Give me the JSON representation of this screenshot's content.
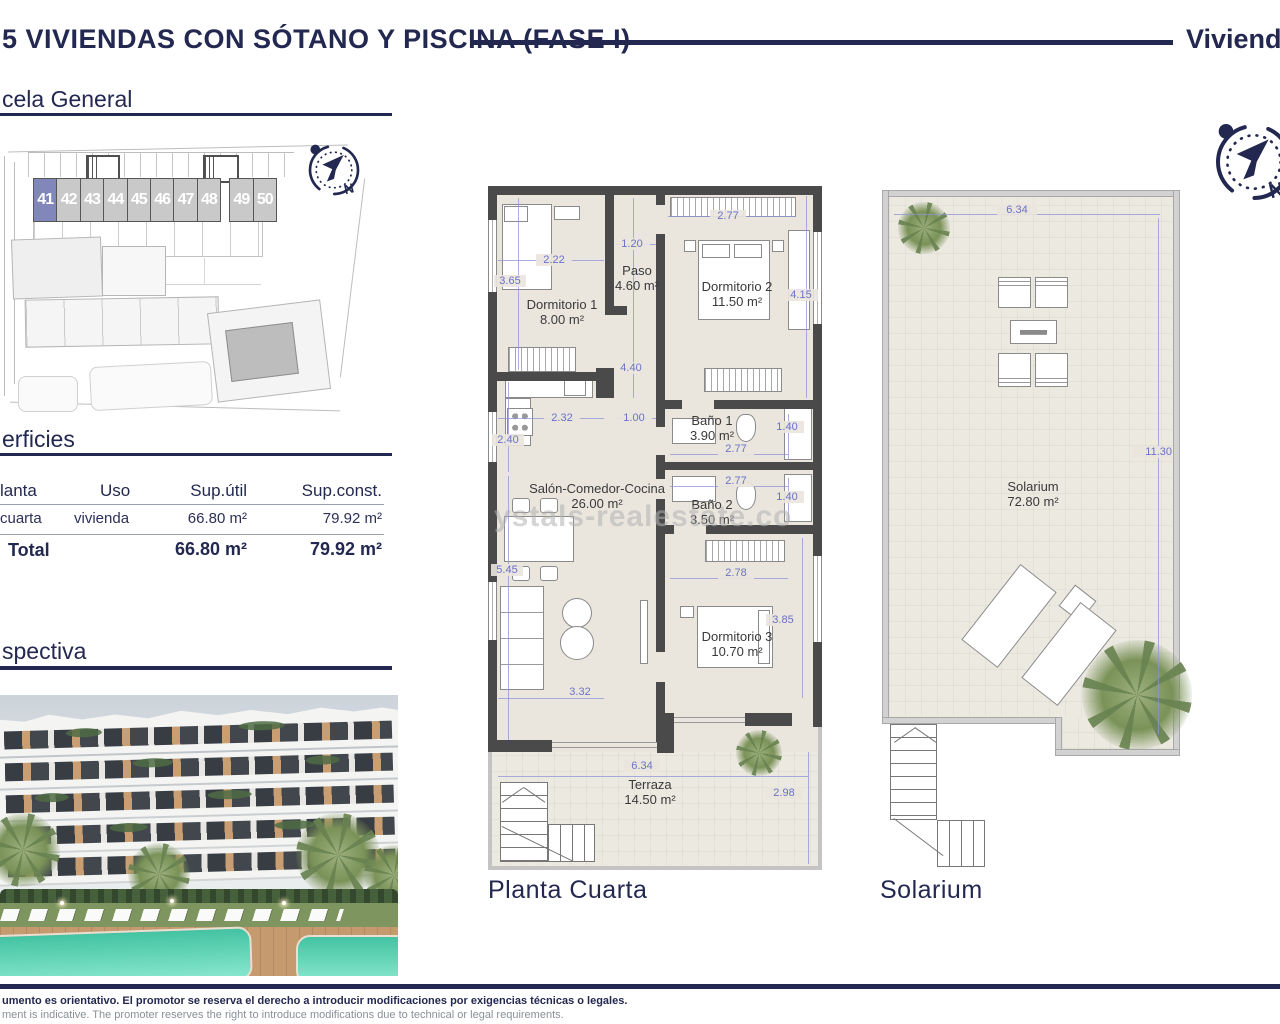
{
  "colors": {
    "navy": "#232850",
    "dim_blue": "#6a71c7",
    "wall_dark": "#4a4a4a",
    "unit_highlight": "#8187ba",
    "unit_gray": "#c9c9c9",
    "floor_beige": "#eae6de",
    "pool_teal": "#43c3a2"
  },
  "header": {
    "title": "5 VIVIENDAS CON SÓTANO Y PISCINA (FASE I)",
    "right_title": "Vivienda"
  },
  "sections": {
    "site": "cela General",
    "surfaces": "erficies",
    "perspective": "spectiva"
  },
  "site_plan": {
    "units": [
      "41",
      "42",
      "43",
      "44",
      "45",
      "46",
      "47",
      "48",
      "49",
      "50"
    ],
    "highlighted_unit": "41"
  },
  "surfaces_table": {
    "columns": [
      "lanta",
      "Uso",
      "Sup.útil",
      "Sup.const."
    ],
    "row": {
      "planta": "cuarta",
      "uso": "vivienda",
      "sup_util": "66.80 m²",
      "sup_const": "79.92 m²"
    },
    "total": {
      "label": "Total",
      "sup_util": "66.80 m²",
      "sup_const": "79.92 m²"
    }
  },
  "floor_plan": {
    "caption": "Planta Cuarta",
    "rooms": [
      {
        "name": "Dormitorio 1",
        "area": "8.00 m²"
      },
      {
        "name": "Paso",
        "area": "4.60 m²"
      },
      {
        "name": "Dormitorio 2",
        "area": "11.50 m²"
      },
      {
        "name": "Baño 1",
        "area": "3.90 m²"
      },
      {
        "name": "Baño 2",
        "area": "3.50 m²"
      },
      {
        "name": "Salón-Comedor-Cocina",
        "area": "26.00 m²"
      },
      {
        "name": "Dormitorio 3",
        "area": "10.70 m²"
      },
      {
        "name": "Terraza",
        "area": "14.50 m²"
      }
    ],
    "dims": {
      "dorm2_w": "2.77",
      "dorm2_h": "4.15",
      "paso_w": "1.20",
      "dorm1_w": "2.22",
      "dorm1_h": "3.65",
      "paso_h": "4.40",
      "kitchen_w": "2.32",
      "hall_w": "1.00",
      "kitchen_h": "2.40",
      "bano1_h": "1.40",
      "bano1_w": "2.77",
      "bano2_w": "2.77",
      "bano2_h": "1.40",
      "salon_h": "5.45",
      "dorm3_w": "2.78",
      "dorm3_h": "3.85",
      "salon_w": "3.32",
      "terraza_w": "6.34",
      "terraza_h": "2.98"
    }
  },
  "solarium_plan": {
    "caption": "Solarium",
    "room": {
      "name": "Solarium",
      "area": "72.80 m²"
    },
    "dims": {
      "w": "6.34",
      "h": "11.30"
    }
  },
  "compass": {
    "label": "N"
  },
  "watermark": "ystals-realestate.co",
  "footer": {
    "es": "umento es orientativo. El promotor se reserva el derecho a introducir modificaciones por exigencias técnicas o legales.",
    "en": "ment is indicative. The promoter reserves the right to introduce modifications due to technical or legal requirements."
  }
}
